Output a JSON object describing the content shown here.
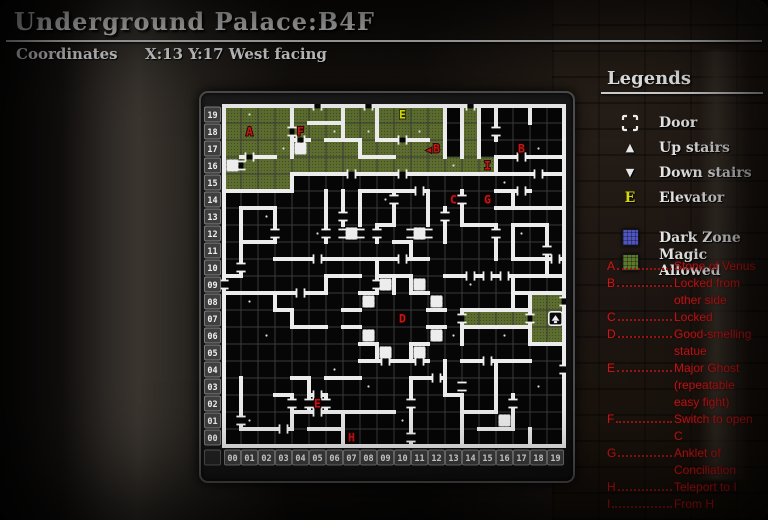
{
  "header": {
    "title": "Underground Palace:B4F",
    "coords_label": "Coordinates",
    "coords_value": "X:13 Y:17 West facing"
  },
  "legends": {
    "title": "Legends",
    "items": [
      {
        "icon": "door-icon",
        "label": "Door"
      },
      {
        "icon": "up-stairs-icon",
        "glyph": "▲",
        "label": "Up stairs"
      },
      {
        "icon": "down-stairs-icon",
        "glyph": "▼",
        "label": "Down stairs"
      },
      {
        "icon": "elevator-icon",
        "glyph": "E",
        "label": "Elevator"
      },
      {
        "icon": "dark-zone-swatch",
        "label": "Dark Zone"
      },
      {
        "icon": "magic-allowed-swatch",
        "label": "Magic Allowed"
      }
    ]
  },
  "notes": [
    {
      "key": "A",
      "text": "Stone of Venus",
      "cont": []
    },
    {
      "key": "B",
      "text": "Locked from",
      "cont": [
        "other side"
      ]
    },
    {
      "key": "C",
      "text": "Locked",
      "cont": []
    },
    {
      "key": "D",
      "text": "Good-smelling",
      "cont": [
        "statue"
      ]
    },
    {
      "key": "E",
      "text": "Major Ghost",
      "cont": [
        "(repeatable",
        "easy fight)"
      ]
    },
    {
      "key": "F",
      "text": "Switch to open",
      "cont": [
        "C"
      ]
    },
    {
      "key": "G",
      "text": "Anklet of",
      "cont": [
        "Conciliation"
      ]
    },
    {
      "key": "H",
      "text": "Teleport to I",
      "cont": []
    },
    {
      "key": "I",
      "text": "From H",
      "cont": []
    }
  ],
  "colors": {
    "marker_red": "#c41717",
    "elevator_yellow": "#d6d80a",
    "magic_green": "#5c6d2f",
    "dark_zone_blue": "#5056c0",
    "wall_white": "#ececec",
    "floor_black": "#060606",
    "grid_gray": "#3a3a3a"
  },
  "map": {
    "cols": 20,
    "rows": 20,
    "col_labels": [
      "00",
      "01",
      "02",
      "03",
      "04",
      "05",
      "06",
      "07",
      "08",
      "09",
      "10",
      "11",
      "12",
      "13",
      "14",
      "15",
      "16",
      "17",
      "18",
      "19"
    ],
    "row_labels": [
      "00",
      "01",
      "02",
      "03",
      "04",
      "05",
      "06",
      "07",
      "08",
      "09",
      "10",
      "11",
      "12",
      "13",
      "14",
      "15",
      "16",
      "17",
      "18",
      "19"
    ],
    "green_rects": [
      [
        0,
        17,
        13,
        3
      ],
      [
        0,
        16,
        16,
        1
      ],
      [
        0,
        15,
        4,
        1
      ],
      [
        14,
        17,
        1,
        3
      ],
      [
        14,
        7,
        4,
        1
      ],
      [
        18,
        6,
        2,
        3
      ]
    ],
    "white_cells": [
      [
        0,
        16
      ],
      [
        4,
        17
      ],
      [
        7,
        12
      ],
      [
        11,
        12
      ],
      [
        9,
        9
      ],
      [
        11,
        9
      ],
      [
        8,
        8
      ],
      [
        12,
        8
      ],
      [
        8,
        6
      ],
      [
        12,
        6
      ],
      [
        9,
        5
      ],
      [
        11,
        5
      ],
      [
        16,
        1
      ]
    ],
    "h_walls": [
      [
        0,
        0,
        20
      ],
      [
        20,
        0,
        20
      ],
      [
        15,
        0,
        4
      ],
      [
        16,
        4,
        16
      ],
      [
        16,
        16,
        20
      ],
      [
        17,
        1,
        3
      ],
      [
        19,
        5,
        7
      ],
      [
        18,
        6,
        8
      ],
      [
        18,
        9,
        12
      ],
      [
        17,
        8,
        10
      ],
      [
        17,
        16,
        20
      ],
      [
        15,
        16,
        18
      ],
      [
        14,
        16,
        20
      ],
      [
        15,
        8,
        12
      ],
      [
        13,
        14,
        16
      ],
      [
        13,
        17,
        19
      ],
      [
        11,
        17,
        19
      ],
      [
        10,
        13,
        20
      ],
      [
        11,
        18,
        20
      ],
      [
        9,
        17,
        20
      ],
      [
        8,
        14,
        18
      ],
      [
        7,
        14,
        18
      ],
      [
        6,
        18,
        20
      ],
      [
        13,
        9,
        10
      ],
      [
        12,
        10,
        11
      ],
      [
        11,
        3,
        12
      ],
      [
        10,
        9,
        11
      ],
      [
        10,
        6,
        8
      ],
      [
        10,
        0,
        1
      ],
      [
        9,
        0,
        6
      ],
      [
        8,
        3,
        4
      ],
      [
        7,
        4,
        6
      ],
      [
        9,
        8,
        9
      ],
      [
        9,
        11,
        12
      ],
      [
        6,
        8,
        9
      ],
      [
        6,
        11,
        12
      ],
      [
        8,
        7,
        8
      ],
      [
        8,
        12,
        13
      ],
      [
        7,
        7,
        8
      ],
      [
        7,
        12,
        13
      ],
      [
        5,
        8,
        12
      ],
      [
        14,
        1,
        3
      ],
      [
        12,
        1,
        3
      ],
      [
        1,
        1,
        4
      ],
      [
        3,
        3,
        4
      ],
      [
        4,
        4,
        5
      ],
      [
        3,
        5,
        6
      ],
      [
        2,
        4,
        7
      ],
      [
        1,
        5,
        7
      ],
      [
        4,
        11,
        13
      ],
      [
        2,
        7,
        10
      ],
      [
        4,
        6,
        8
      ],
      [
        3,
        13,
        14
      ],
      [
        1,
        15,
        17
      ],
      [
        2,
        14,
        16
      ],
      [
        5,
        14,
        18
      ],
      [
        18,
        4,
        5
      ]
    ],
    "v_walls": [
      [
        0,
        0,
        20
      ],
      [
        20,
        0,
        20
      ],
      [
        4,
        15,
        16
      ],
      [
        16,
        16,
        17
      ],
      [
        4,
        17,
        20
      ],
      [
        7,
        18,
        20
      ],
      [
        8,
        17,
        18
      ],
      [
        9,
        18,
        20
      ],
      [
        13,
        17,
        20
      ],
      [
        14,
        17,
        20
      ],
      [
        15,
        17,
        20
      ],
      [
        16,
        18,
        20
      ],
      [
        18,
        19,
        20
      ],
      [
        17,
        14,
        15
      ],
      [
        14,
        13,
        15
      ],
      [
        16,
        11,
        13
      ],
      [
        17,
        11,
        13
      ],
      [
        19,
        10,
        13
      ],
      [
        17,
        8,
        10
      ],
      [
        14,
        6,
        8
      ],
      [
        18,
        6,
        9
      ],
      [
        8,
        13,
        15
      ],
      [
        10,
        13,
        15
      ],
      [
        9,
        12,
        13
      ],
      [
        11,
        11,
        12
      ],
      [
        12,
        13,
        15
      ],
      [
        13,
        12,
        14
      ],
      [
        10,
        9,
        10
      ],
      [
        11,
        9,
        10
      ],
      [
        9,
        9,
        11
      ],
      [
        6,
        9,
        10
      ],
      [
        9,
        5,
        6
      ],
      [
        11,
        5,
        6
      ],
      [
        1,
        10,
        14
      ],
      [
        3,
        12,
        14
      ],
      [
        6,
        12,
        15
      ],
      [
        7,
        13,
        15
      ],
      [
        3,
        8,
        9
      ],
      [
        4,
        7,
        8
      ],
      [
        1,
        1,
        4
      ],
      [
        4,
        1,
        3
      ],
      [
        5,
        3,
        4
      ],
      [
        5,
        2,
        3
      ],
      [
        6,
        2,
        3
      ],
      [
        7,
        0,
        2
      ],
      [
        11,
        0,
        4
      ],
      [
        13,
        3,
        5
      ],
      [
        14,
        0,
        3
      ],
      [
        16,
        2,
        5
      ],
      [
        17,
        1,
        3
      ],
      [
        18,
        0,
        1
      ]
    ],
    "h_doors": [
      [
        20,
        5
      ],
      [
        20,
        8
      ],
      [
        20,
        14
      ],
      [
        16,
        7
      ],
      [
        16,
        10
      ],
      [
        16,
        18
      ],
      [
        17,
        1
      ],
      [
        17,
        17
      ],
      [
        18,
        4
      ],
      [
        18,
        10
      ],
      [
        15,
        11
      ],
      [
        15,
        17
      ],
      [
        11,
        5
      ],
      [
        11,
        10
      ],
      [
        11,
        19
      ],
      [
        10,
        14
      ],
      [
        10,
        15
      ],
      [
        10,
        16
      ],
      [
        9,
        4
      ],
      [
        5,
        9
      ],
      [
        5,
        11
      ],
      [
        5,
        15
      ],
      [
        4,
        12
      ],
      [
        3,
        5
      ],
      [
        2,
        5
      ],
      [
        1,
        3
      ]
    ],
    "v_doors": [
      [
        0,
        9
      ],
      [
        1,
        16
      ],
      [
        1,
        10
      ],
      [
        1,
        1
      ],
      [
        3,
        12
      ],
      [
        4,
        18
      ],
      [
        4,
        2
      ],
      [
        5,
        2
      ],
      [
        6,
        2
      ],
      [
        6,
        12
      ],
      [
        7,
        12
      ],
      [
        7,
        13
      ],
      [
        8,
        12
      ],
      [
        9,
        9
      ],
      [
        9,
        12
      ],
      [
        10,
        14
      ],
      [
        11,
        0
      ],
      [
        11,
        2
      ],
      [
        11,
        12
      ],
      [
        12,
        12
      ],
      [
        13,
        13
      ],
      [
        14,
        7
      ],
      [
        14,
        14
      ],
      [
        14,
        3
      ],
      [
        16,
        18
      ],
      [
        16,
        12
      ],
      [
        17,
        2
      ],
      [
        18,
        7
      ],
      [
        19,
        11
      ],
      [
        20,
        4
      ],
      [
        20,
        8
      ]
    ],
    "dots": [
      [
        1,
        19
      ],
      [
        3,
        17
      ],
      [
        6,
        18
      ],
      [
        8,
        18
      ],
      [
        11,
        18
      ],
      [
        13,
        16
      ],
      [
        18,
        17
      ],
      [
        16,
        15
      ],
      [
        2,
        13
      ],
      [
        5,
        12
      ],
      [
        9,
        14
      ],
      [
        1,
        8
      ],
      [
        2,
        6
      ],
      [
        6,
        4
      ],
      [
        1,
        1
      ],
      [
        8,
        3
      ],
      [
        14,
        9
      ],
      [
        16,
        6
      ],
      [
        18,
        3
      ],
      [
        10,
        1
      ],
      [
        13,
        6
      ],
      [
        17,
        12
      ]
    ],
    "markers": [
      {
        "t": "A",
        "x": 1,
        "y": 18,
        "c": "red"
      },
      {
        "t": "F",
        "x": 4,
        "y": 18,
        "c": "red"
      },
      {
        "t": "E",
        "x": 10,
        "y": 19,
        "c": "yellow"
      },
      {
        "t": "◀",
        "x": 11.55,
        "y": 17,
        "c": "red",
        "s": 8
      },
      {
        "t": "B",
        "x": 12,
        "y": 17,
        "c": "red"
      },
      {
        "t": "B",
        "x": 17,
        "y": 17,
        "c": "red"
      },
      {
        "t": "I",
        "x": 15,
        "y": 16,
        "c": "red"
      },
      {
        "t": "C",
        "x": 13,
        "y": 14,
        "c": "red"
      },
      {
        "t": "G",
        "x": 15,
        "y": 14,
        "c": "red"
      },
      {
        "t": "D",
        "x": 10,
        "y": 7,
        "c": "red"
      },
      {
        "t": "E",
        "x": 5,
        "y": 2,
        "c": "red"
      },
      {
        "t": "H",
        "x": 7,
        "y": 0,
        "c": "red"
      }
    ],
    "stairs_up": [
      19,
      7
    ]
  }
}
